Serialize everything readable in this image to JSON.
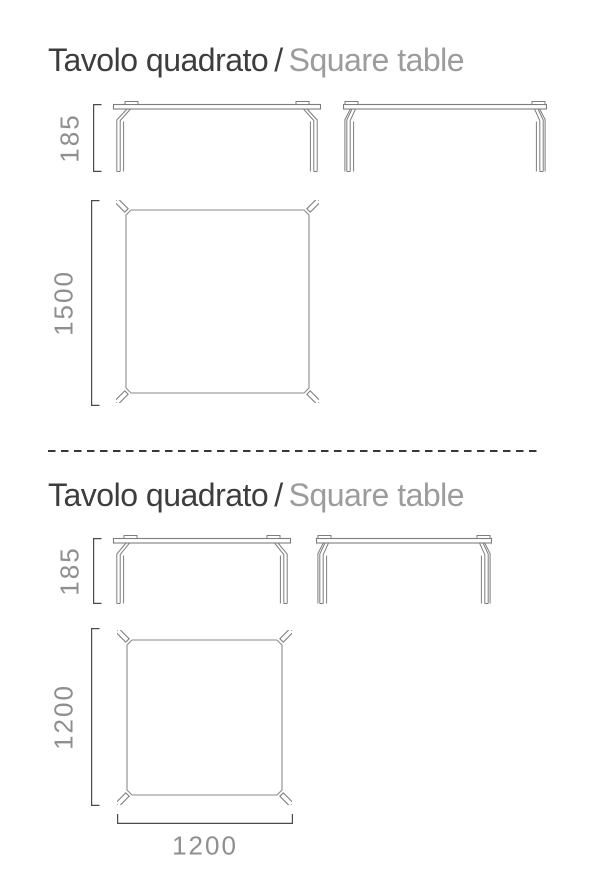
{
  "colors": {
    "background": "#ffffff",
    "title_dark": "#3d3d3d",
    "title_gray": "#9c9c9c",
    "drawing_line": "#7d7d7d",
    "drawing_line_light": "#8a8a8a",
    "dimension_bracket": "#4a4a4a",
    "dimension_text": "#8f8f8f",
    "divider": "#383838"
  },
  "sections": [
    {
      "title_it": "Tavolo quadrato",
      "title_sep": "/",
      "title_en": "Square table",
      "views": {
        "front_height": "185",
        "plan_depth": "1500"
      }
    },
    {
      "title_it": "Tavolo quadrato",
      "title_sep": "/",
      "title_en": "Square table",
      "views": {
        "front_height": "185",
        "plan_depth": "1200",
        "plan_width": "1200"
      }
    }
  ]
}
